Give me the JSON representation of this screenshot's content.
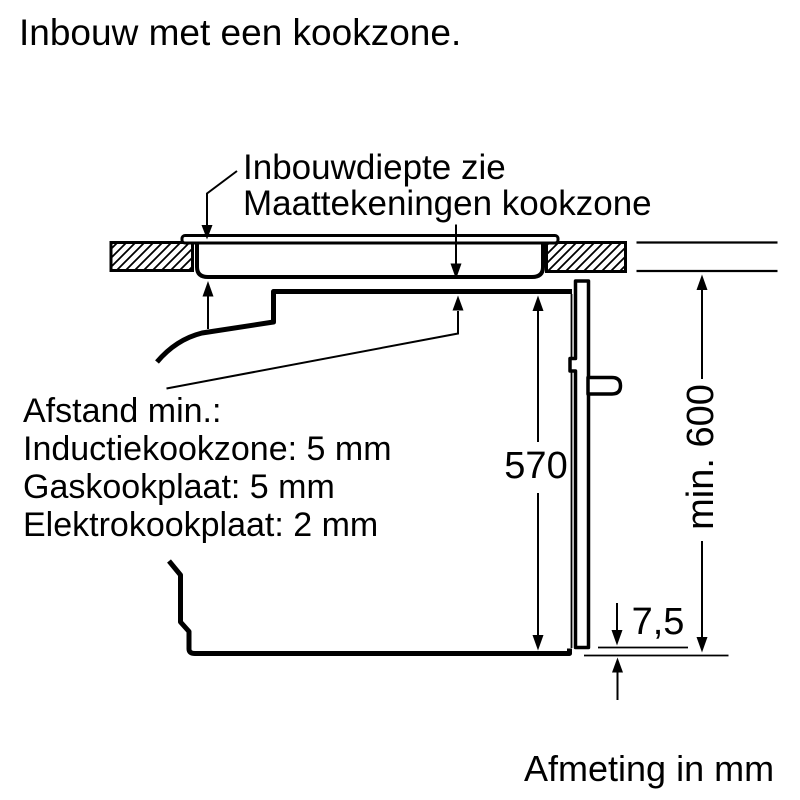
{
  "title": "Inbouw met een kookzone.",
  "callout": {
    "lines": [
      "Inbouwdiepte zie",
      "Maattekeningen kookzone"
    ]
  },
  "clearance_note": {
    "lines": [
      "Afstand min.:",
      "Inductiekookzone: 5 mm",
      "Gaskookplaat: 5 mm",
      "Elektrokookplaat: 2 mm"
    ]
  },
  "dimensions": {
    "oven_height_mm": "570",
    "niche_height_mm": "min. 600",
    "door_bottom_gap_mm": "7,5"
  },
  "footer_note": "Afmeting in mm",
  "colors": {
    "ink": "#000000",
    "background": "#ffffff"
  }
}
